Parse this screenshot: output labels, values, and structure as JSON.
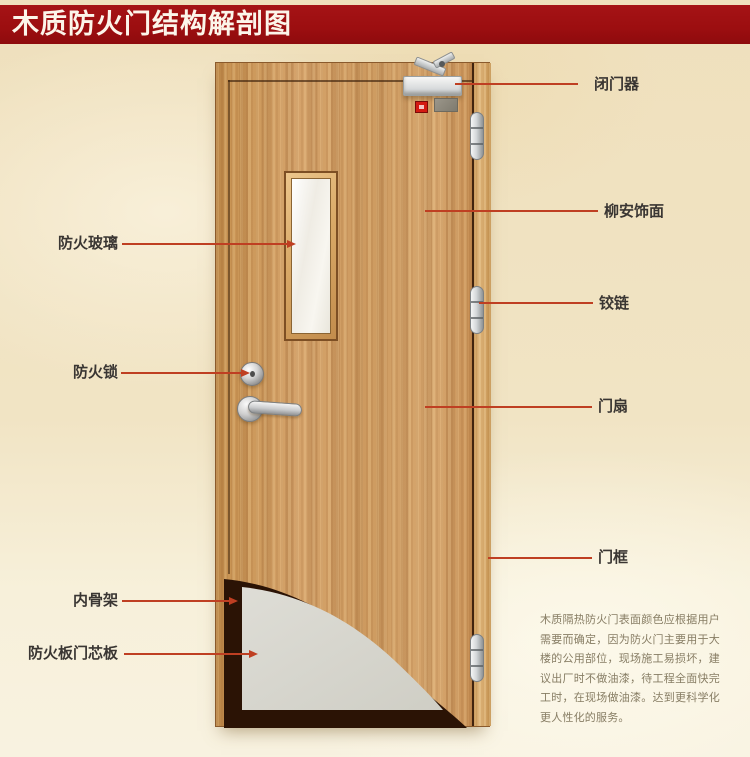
{
  "title": "木质防火门结构解剖图",
  "labels": {
    "left": [
      {
        "text": "防火玻璃"
      },
      {
        "text": "防火锁"
      },
      {
        "text": "内骨架"
      },
      {
        "text": "防火板门芯板"
      }
    ],
    "right": [
      {
        "text": "闭门器"
      },
      {
        "text": "柳安饰面"
      },
      {
        "text": "铰链"
      },
      {
        "text": "门扇"
      },
      {
        "text": "门框"
      }
    ]
  },
  "description": "木质隔热防火门表面颜色应根据用户需要而确定，因为防火门主要用于大楼的公用部位，现场施工易损坏，建议出厂时不做油漆，待工程全面快完工时，在现场做油漆。达到更科学化更人性化的服务。",
  "colors": {
    "banner_red": "#9c0e10",
    "pointer_red": "#bf3f22",
    "door_wood": "#cf9b62",
    "frame_wood": "#d2a365",
    "core_gray": "#d9d8d0",
    "skeleton_brown": "#2b1305",
    "background_beige": "#f1e4c4",
    "label_text": "#3a3633",
    "description_text": "#877d64"
  }
}
